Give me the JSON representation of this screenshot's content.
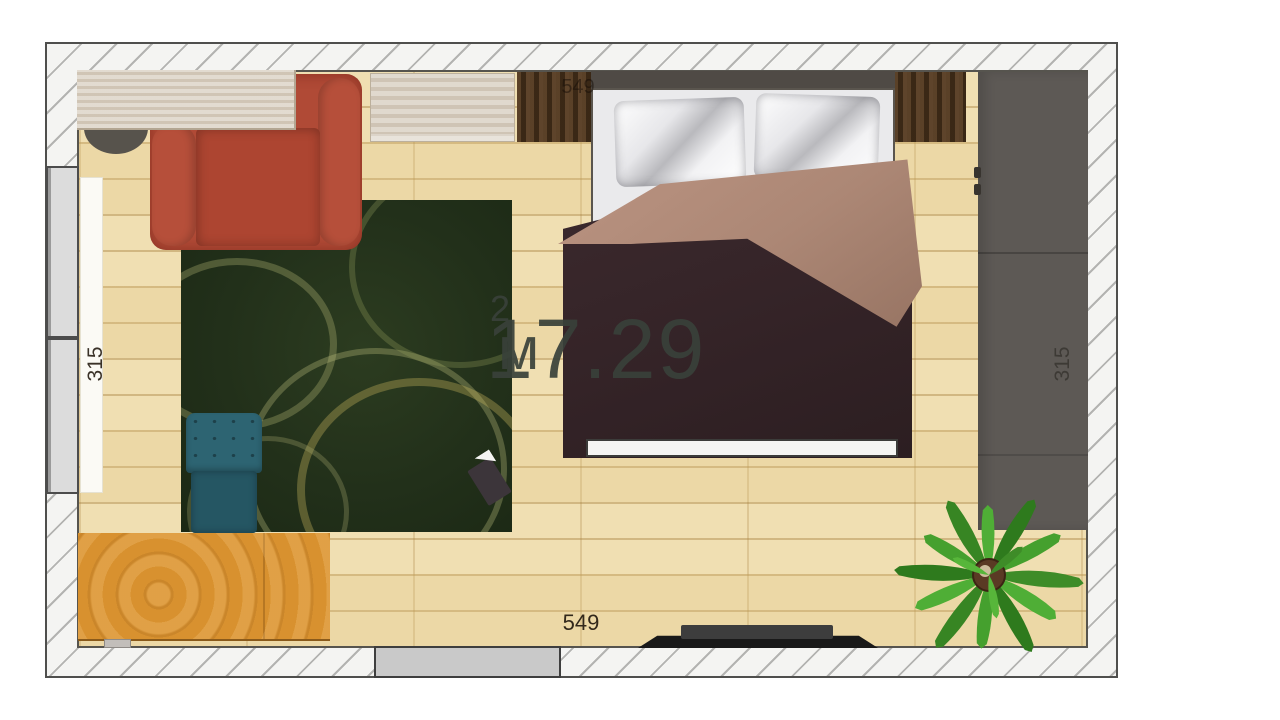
{
  "scene": {
    "type": "bedroom-floor-plan"
  },
  "labels": {
    "area_value": "17.29",
    "area_unit": "м",
    "area_sup": "2",
    "dim_top": "549",
    "dim_bottom": "549",
    "dim_left": "315",
    "dim_right": "315"
  },
  "objects": [
    {
      "name": "desk",
      "color": "#d9cfc1"
    },
    {
      "name": "office-chair",
      "color": "#57534c"
    },
    {
      "name": "armchair",
      "color": "#b04a36"
    },
    {
      "name": "wall-shelf",
      "color": "#d8cec0"
    },
    {
      "name": "overhead-cabinet",
      "color": "#4b3522"
    },
    {
      "name": "double-bed",
      "colors": {
        "duvet": "#352428",
        "blanket": "#ac8775",
        "pillows": "#f2f2f4",
        "headboard": "#4f4a45"
      }
    },
    {
      "name": "rug",
      "color": "#22301a"
    },
    {
      "name": "kids-chair",
      "color": "#2d6472"
    },
    {
      "name": "book",
      "color": "#3c353a"
    },
    {
      "name": "coffee-table",
      "color": "#d8912f"
    },
    {
      "name": "wardrobe",
      "color": "#5d5955"
    },
    {
      "name": "plant",
      "color": "#43a02c"
    },
    {
      "name": "tv",
      "color": "#242424"
    },
    {
      "name": "window",
      "color": "#dcdcdc"
    },
    {
      "name": "door",
      "color": "#c9c9c9"
    }
  ],
  "colors": {
    "floor": "#f0dfb2",
    "wall_fill": "#f4f4f2",
    "wall_hatch": "#b3b3b1"
  }
}
